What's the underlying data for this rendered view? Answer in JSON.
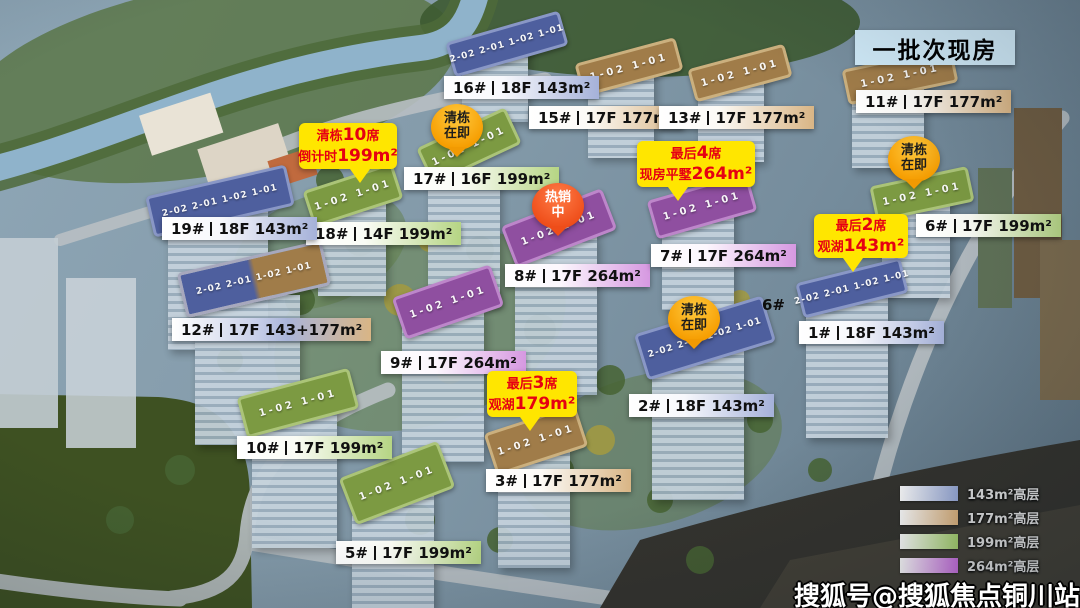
{
  "header": {
    "title": "一批次现房"
  },
  "watermark": {
    "text": "搜狐号@搜狐焦点铜川站"
  },
  "map_note": {
    "text": "6#"
  },
  "buildings": [
    {
      "num": "16#",
      "spec": "18F 143m²",
      "type": "143m²"
    },
    {
      "num": "15#",
      "spec": "17F 177m²",
      "type": "177m²"
    },
    {
      "num": "13#",
      "spec": "17F 177m²",
      "type": "177m²"
    },
    {
      "num": "11#",
      "spec": "17F 177m²",
      "type": "177m²"
    },
    {
      "num": "17#",
      "spec": "16F 199m²",
      "type": "199m²"
    },
    {
      "num": "18#",
      "spec": "14F 199m²",
      "type": "199m²"
    },
    {
      "num": "19#",
      "spec": "18F 143m²",
      "type": "143m²"
    },
    {
      "num": "12#",
      "spec": "17F 143+177m²",
      "type": "143m²+177m²"
    },
    {
      "num": "8#",
      "spec": "17F 264m²",
      "type": "264m²"
    },
    {
      "num": "7#",
      "spec": "17F 264m²",
      "type": "264m²"
    },
    {
      "num": "9#",
      "spec": "17F 264m²",
      "type": "264m²"
    },
    {
      "num": "6#",
      "spec": "17F 199m²",
      "type": "199m²"
    },
    {
      "num": "1#",
      "spec": "18F 143m²",
      "type": "143m²"
    },
    {
      "num": "2#",
      "spec": "18F 143m²",
      "type": "143m²"
    },
    {
      "num": "3#",
      "spec": "17F 177m²",
      "type": "177m²"
    },
    {
      "num": "10#",
      "spec": "17F 199m²",
      "type": "199m²"
    },
    {
      "num": "5#",
      "spec": "17F 199m²",
      "type": "199m²"
    }
  ],
  "pins": [
    {
      "line1": "清栋",
      "line2": "在即"
    },
    {
      "line1": "清栋",
      "line2": "在即"
    },
    {
      "line1": "清栋",
      "line2": "在即"
    },
    {
      "line1": "热销",
      "line2": "中"
    }
  ],
  "bubbles": [
    {
      "l1a": "清栋",
      "l1b": "10",
      "l1c": "席",
      "l2a": "倒计时",
      "l2b": "199m²"
    },
    {
      "l1a": "最后",
      "l1b": "4",
      "l1c": "席",
      "l2a": "现房平墅",
      "l2b": "264m²"
    },
    {
      "l1a": "最后",
      "l1b": "2",
      "l1c": "席",
      "l2a": "观湖",
      "l2b": "143m²"
    },
    {
      "l1a": "最后",
      "l1b": "3",
      "l1c": "席",
      "l2a": "观湖",
      "l2b": "179m²"
    }
  ],
  "legend": {
    "items": [
      {
        "label": "143m²高层"
      },
      {
        "label": "177m²高层"
      },
      {
        "label": "199m²高层"
      },
      {
        "label": "264m²高层"
      }
    ]
  },
  "roofs": [
    {
      "units": "2-02 2-01 1-02 1-01"
    },
    {
      "units": "1-02 1-01"
    },
    {
      "units": "1-02 1-01"
    },
    {
      "units": "1-02 1-01"
    },
    {
      "units": "1-02 1-01"
    },
    {
      "units": "1-02 1-01"
    },
    {
      "units": "2-02 2-01 1-02 1-01"
    },
    {
      "units": "2-02 2-01 1-02 1-01"
    },
    {
      "units": "1-02 1-01"
    },
    {
      "units": "1-02 1-01"
    },
    {
      "units": "1-02 1-01"
    },
    {
      "units": "1-02 1-01"
    },
    {
      "units": "2-02 2-01 1-02 1-01"
    },
    {
      "units": "2-02 2-01 1-02 1-01"
    },
    {
      "units": "1-02 1-01"
    },
    {
      "units": "1-02 1-01"
    },
    {
      "units": "1-02 1-01"
    }
  ],
  "colors": {
    "size_143": "#98a9d8",
    "size_177": "#ddb27c",
    "size_199": "#a8d36e",
    "size_264": "#c96fe0",
    "bubble_bg": "#ffe600",
    "bubble_text": "#e60012",
    "pin_orange": "#f69d00",
    "pin_hot": "#ee4d19",
    "header_bg": "#cfe9f7"
  }
}
